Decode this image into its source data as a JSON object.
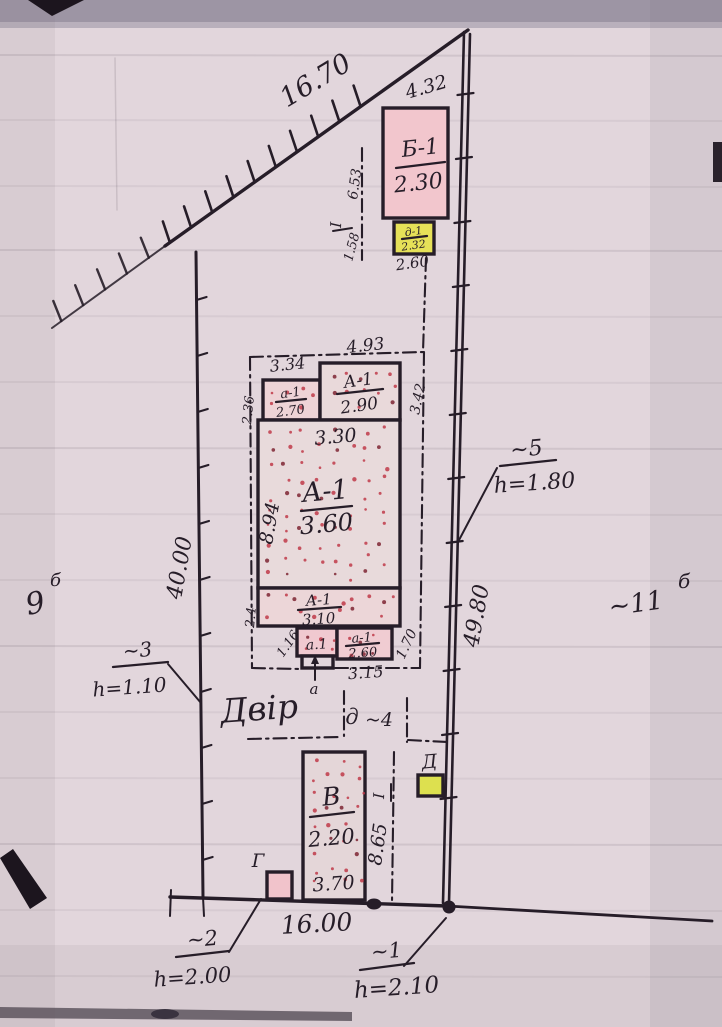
{
  "colors": {
    "paper": "#e2d6dc",
    "ink": "#261d28",
    "building_pink": "#f2c6cd",
    "building_yellow": "#e6e158",
    "stipple_red": "#bf3a49",
    "photo_background": "#9d95a4"
  },
  "site_plan": {
    "yard_label": "Двір",
    "boundary": {
      "top_length": "16.70",
      "top_right_length": "4.32",
      "left_length": "40.00",
      "right_length": "49.80",
      "bottom_length": "16.00"
    },
    "buildings": {
      "b1": {
        "label": "Б-1",
        "value": "2.30"
      },
      "d1": {
        "label": "д-1",
        "value": "2.32"
      },
      "a1_annex": {
        "label": "а-1",
        "value": "2.70"
      },
      "a1_top": {
        "label": "А-1",
        "value": "2.90"
      },
      "a1_main": {
        "label": "А-1",
        "value": "3.60"
      },
      "a1_strip": {
        "label": "А-1",
        "value": "3.10"
      },
      "a_small": {
        "label": "а.1"
      },
      "a1_porch": {
        "label": "а-1",
        "value": "2.60"
      },
      "v": {
        "label": "В",
        "value": "2.20"
      },
      "g": {
        "label": "Г"
      },
      "d_shed": {
        "label": "Д"
      }
    },
    "dims": {
      "d653": "6.53",
      "d158": "1.58",
      "d260": "2.60",
      "d334": "3.34",
      "d493": "4.93",
      "d342": "3.42",
      "d236": "2.36",
      "d330": "3.30",
      "d894": "8.94",
      "d24": "2.4",
      "d116": "1.16",
      "d170": "1.70",
      "d315": "3.15",
      "d370": "3.70",
      "d865": "8.65"
    },
    "fences": {
      "f1": {
        "no": "~1",
        "h": "h=2.10"
      },
      "f2": {
        "no": "~2",
        "h": "h=2.00"
      },
      "f3": {
        "no": "~3",
        "h": "h=1.10"
      },
      "f5": {
        "no": "~5",
        "h": "h=1.80"
      }
    },
    "gate": {
      "letter": "д",
      "no": "~4"
    },
    "parcels": {
      "left": {
        "no": "9",
        "sup": "б"
      },
      "right": {
        "no": "~11",
        "sup": "б"
      }
    },
    "marks": {
      "roman": "І",
      "a_ref": "а"
    }
  }
}
